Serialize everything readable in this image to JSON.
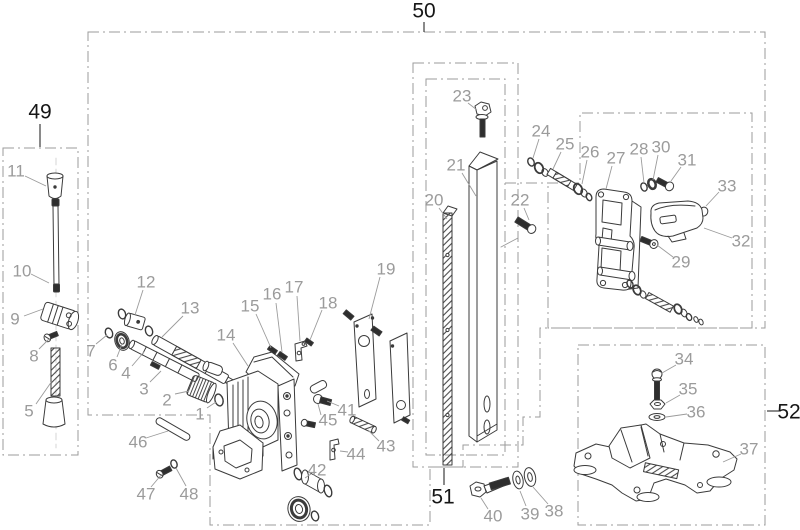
{
  "figure": {
    "type": "exploded-parts-diagram",
    "description": "Exploded view parts diagram of a drill-stand style machine with numbered components and dash-dot group boxes"
  },
  "colors": {
    "line": "#3b3b3b",
    "dark_fill": "#2e2e2e",
    "label": "#9b9b9b",
    "group_label": "#161616",
    "box_dash": "#9b9b9b",
    "background": "#ffffff"
  },
  "group_boxes": [
    {
      "id": "box-49",
      "label": "49",
      "label_x": 40,
      "label_y": 112,
      "tick": [
        40,
        124,
        40,
        147
      ]
    },
    {
      "id": "box-50",
      "label": "50",
      "label_x": 424,
      "label_y": 11,
      "tick": [
        424,
        22,
        424,
        32
      ]
    },
    {
      "id": "box-51",
      "label": "51",
      "label_x": 443,
      "label_y": 497,
      "tick": [
        444,
        468,
        444,
        485
      ]
    },
    {
      "id": "box-52",
      "label": "52",
      "label_x": 789,
      "label_y": 412,
      "tick": [
        767,
        411,
        779,
        411
      ]
    }
  ],
  "part_labels": [
    {
      "n": "1",
      "x": 200,
      "y": 414,
      "leader": [
        207,
        408,
        216,
        402
      ]
    },
    {
      "n": "2",
      "x": 167,
      "y": 400,
      "leader": [
        175,
        394,
        189,
        391
      ]
    },
    {
      "n": "3",
      "x": 144,
      "y": 389,
      "leader": [
        150,
        382,
        161,
        371
      ]
    },
    {
      "n": "4",
      "x": 126,
      "y": 373,
      "leader": [
        132,
        366,
        144,
        352
      ]
    },
    {
      "n": "5",
      "x": 29,
      "y": 411,
      "leader": [
        36,
        404,
        52,
        381
      ]
    },
    {
      "n": "6",
      "x": 113,
      "y": 365,
      "leader": [
        117,
        357,
        122,
        344
      ]
    },
    {
      "n": "7",
      "x": 91,
      "y": 351,
      "leader": [
        96,
        344,
        107,
        335
      ]
    },
    {
      "n": "8",
      "x": 34,
      "y": 356,
      "leader": [
        39,
        349,
        49,
        339
      ]
    },
    {
      "n": "9",
      "x": 15,
      "y": 319,
      "leader": [
        24,
        316,
        43,
        309
      ]
    },
    {
      "n": "10",
      "x": 22,
      "y": 271,
      "leader": [
        31,
        274,
        49,
        283
      ]
    },
    {
      "n": "11",
      "x": 16,
      "y": 171,
      "leader": [
        25,
        176,
        46,
        186
      ]
    },
    {
      "n": "12",
      "x": 146,
      "y": 282,
      "leader": [
        143,
        290,
        135,
        315
      ]
    },
    {
      "n": "13",
      "x": 190,
      "y": 308,
      "leader": [
        183,
        316,
        162,
        337
      ]
    },
    {
      "n": "14",
      "x": 226,
      "y": 335,
      "leader": [
        233,
        343,
        248,
        366
      ]
    },
    {
      "n": "15",
      "x": 250,
      "y": 306,
      "leader": [
        256,
        314,
        271,
        348
      ]
    },
    {
      "n": "16",
      "x": 272,
      "y": 294,
      "leader": [
        276,
        303,
        282,
        352
      ]
    },
    {
      "n": "17",
      "x": 294,
      "y": 287,
      "leader": [
        297,
        296,
        300,
        341
      ]
    },
    {
      "n": "18",
      "x": 328,
      "y": 303,
      "leader": [
        322,
        310,
        310,
        340
      ]
    },
    {
      "n": "19",
      "x": 386,
      "y": 269,
      "leader": [
        380,
        277,
        369,
        319
      ]
    },
    {
      "n": "20",
      "x": 434,
      "y": 200,
      "leader": [
        439,
        208,
        447,
        219
      ]
    },
    {
      "n": "21",
      "x": 456,
      "y": 165,
      "leader": [
        462,
        173,
        476,
        196
      ]
    },
    {
      "n": "22",
      "x": 520,
      "y": 200,
      "leader": [
        524,
        208,
        529,
        220
      ]
    },
    {
      "n": "23",
      "x": 462,
      "y": 96,
      "leader": [
        468,
        103,
        477,
        110
      ]
    },
    {
      "n": "24",
      "x": 541,
      "y": 131,
      "leader": [
        539,
        139,
        533,
        158
      ]
    },
    {
      "n": "25",
      "x": 565,
      "y": 144,
      "leader": [
        561,
        152,
        553,
        169
      ]
    },
    {
      "n": "26",
      "x": 590,
      "y": 152,
      "leader": [
        587,
        160,
        582,
        184
      ]
    },
    {
      "n": "27",
      "x": 616,
      "y": 158,
      "leader": [
        612,
        166,
        606,
        189
      ]
    },
    {
      "n": "28",
      "x": 639,
      "y": 149,
      "leader": [
        641,
        157,
        644,
        183
      ]
    },
    {
      "n": "29",
      "x": 681,
      "y": 262,
      "leader": [
        673,
        257,
        657,
        245
      ]
    },
    {
      "n": "30",
      "x": 661,
      "y": 147,
      "leader": [
        658,
        155,
        653,
        180
      ]
    },
    {
      "n": "31",
      "x": 687,
      "y": 160,
      "leader": [
        681,
        167,
        671,
        181
      ]
    },
    {
      "n": "32",
      "x": 741,
      "y": 241,
      "leader": [
        732,
        238,
        704,
        228
      ]
    },
    {
      "n": "33",
      "x": 727,
      "y": 186,
      "leader": [
        719,
        192,
        706,
        206
      ]
    },
    {
      "n": "34",
      "x": 684,
      "y": 359,
      "leader": [
        676,
        365,
        662,
        373
      ]
    },
    {
      "n": "35",
      "x": 688,
      "y": 389,
      "leader": [
        680,
        395,
        666,
        403
      ]
    },
    {
      "n": "36",
      "x": 696,
      "y": 412,
      "leader": [
        687,
        414,
        666,
        417
      ]
    },
    {
      "n": "37",
      "x": 749,
      "y": 449,
      "leader": [
        741,
        454,
        723,
        462
      ]
    },
    {
      "n": "38",
      "x": 554,
      "y": 511,
      "leader": [
        548,
        504,
        533,
        487
      ]
    },
    {
      "n": "39",
      "x": 530,
      "y": 514,
      "leader": [
        526,
        506,
        520,
        491
      ]
    },
    {
      "n": "40",
      "x": 493,
      "y": 516,
      "leader": [
        488,
        509,
        481,
        498
      ]
    },
    {
      "n": "41",
      "x": 347,
      "y": 410,
      "leader": [
        339,
        406,
        327,
        401
      ]
    },
    {
      "n": "42",
      "x": 317,
      "y": 470,
      "leader": [
        311,
        474,
        305,
        478
      ]
    },
    {
      "n": "43",
      "x": 386,
      "y": 446,
      "leader": [
        379,
        441,
        368,
        430
      ]
    },
    {
      "n": "44",
      "x": 356,
      "y": 454,
      "leader": [
        348,
        452,
        340,
        451
      ]
    },
    {
      "n": "45",
      "x": 328,
      "y": 420,
      "leader": [
        321,
        415,
        318,
        404
      ]
    },
    {
      "n": "46",
      "x": 138,
      "y": 442,
      "leader": [
        146,
        438,
        168,
        431
      ]
    },
    {
      "n": "47",
      "x": 146,
      "y": 494,
      "leader": [
        151,
        487,
        162,
        474
      ]
    },
    {
      "n": "48",
      "x": 189,
      "y": 494,
      "leader": [
        186,
        486,
        176,
        468
      ]
    }
  ]
}
